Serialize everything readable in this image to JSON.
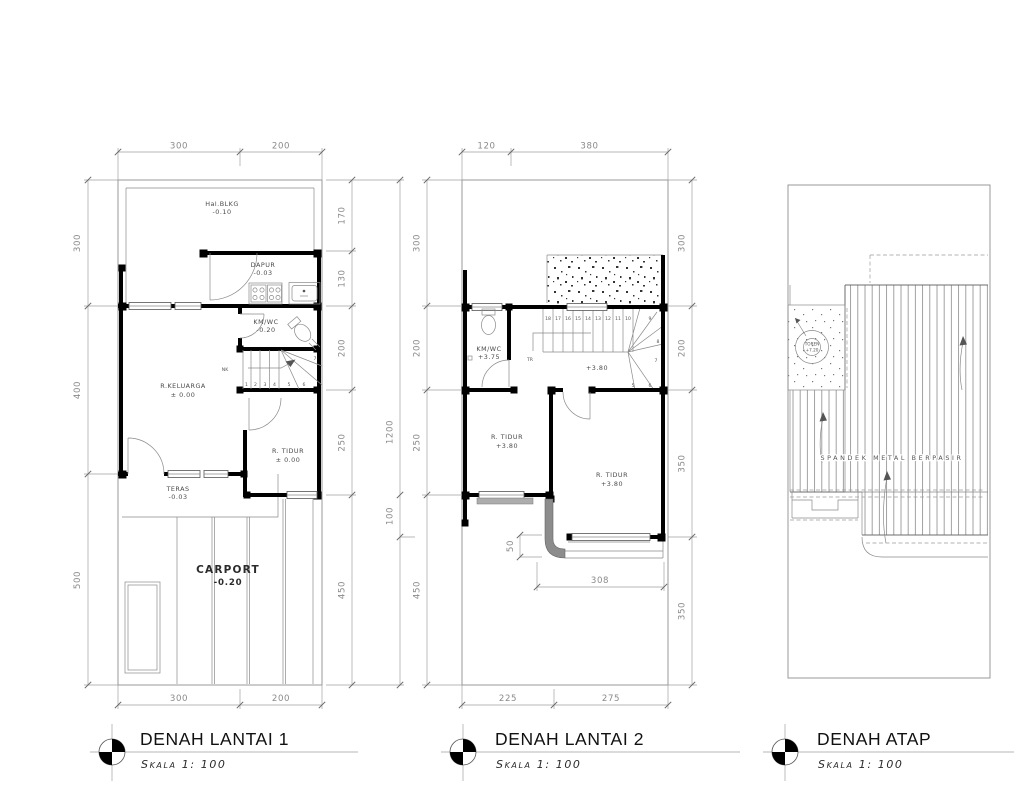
{
  "colors": {
    "wall": "#000000",
    "line": "#8f8f8f",
    "text": "#4a4a4a",
    "canopy": "#8c8c8c"
  },
  "titles": [
    {
      "title": "DENAH LANTAI 1",
      "scale": "Skala 1: 100"
    },
    {
      "title": "DENAH LANTAI 2",
      "scale": "Skala 1: 100"
    },
    {
      "title": "DENAH ATAP",
      "scale": "Skala 1: 100"
    }
  ],
  "lantai1": {
    "rooms": {
      "hal_blkg": {
        "name": "Hal.BLKG",
        "level": "-0.10"
      },
      "dapur": {
        "name": "DAPUR",
        "level": "-0.03"
      },
      "kmwc": {
        "name": "KM/WC",
        "level": "-0.20"
      },
      "keluarga": {
        "name": "R.KELUARGA",
        "level": "± 0.00"
      },
      "tidur": {
        "name": "R. TIDUR",
        "level": "± 0.00"
      },
      "teras": {
        "name": "TERAS",
        "level": "-0.03"
      },
      "carport": {
        "name": "CARPORT",
        "level": "-0.20"
      }
    },
    "stair_note": "NK",
    "stairs": [
      "1",
      "2",
      "3",
      "4",
      "5",
      "6",
      "7"
    ],
    "dims": {
      "top": [
        "300",
        "200"
      ],
      "bottom": [
        "300",
        "200"
      ],
      "left": [
        "300",
        "400",
        "500"
      ],
      "right": [
        "170",
        "130",
        "200",
        "250",
        "450"
      ],
      "total": "1200",
      "sub": "100"
    }
  },
  "lantai2": {
    "rooms": {
      "kmwc": {
        "name": "KM/WC",
        "level": "+3.75"
      },
      "tidur1": {
        "name": "R. TIDUR",
        "level": "+3.80"
      },
      "tidur2": {
        "name": "R. TIDUR",
        "level": "+3.80"
      }
    },
    "landing_level": "+3.80",
    "tr_label": "TR",
    "stairs": [
      "18",
      "17",
      "16",
      "15",
      "14",
      "13",
      "12",
      "11",
      "10",
      "9",
      "8",
      "7",
      "6",
      "5"
    ],
    "dims": {
      "top": [
        "120",
        "380"
      ],
      "bottom": [
        "225",
        "275"
      ],
      "left": [
        "300",
        "200",
        "250",
        "450"
      ],
      "right": [
        "300",
        "200",
        "350",
        "350"
      ],
      "canopy_depth": "50",
      "canopy_width": "308"
    }
  },
  "atap": {
    "toren": {
      "name": "TOREN",
      "level": "+7.20"
    },
    "roof_material": "SPANDEK METAL BERPASIR"
  }
}
